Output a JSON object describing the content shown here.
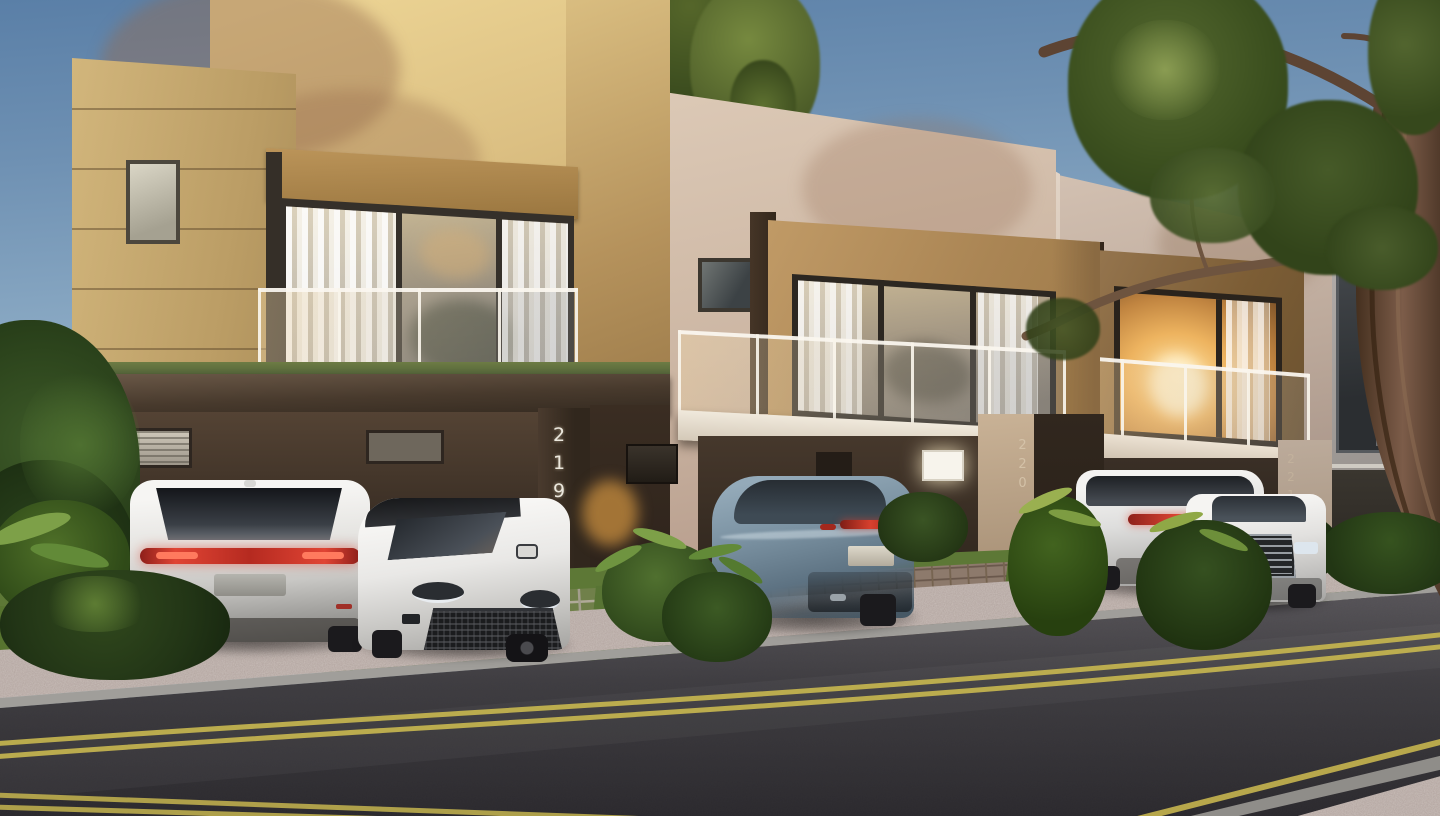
{
  "scene": {
    "house_numbers": {
      "house1": "219",
      "house2": "220",
      "house3": "221"
    },
    "palette": {
      "sky_top": "#5a7fa7",
      "sky_horizon": "#d6dcdc",
      "facade_yellow": "#dcc083",
      "facade_beige": "#cdb7a4",
      "facade_taupe": "#bca99b",
      "accent_tan": "#a9854e",
      "accent_brown": "#73552f",
      "carport_brown": "#3a2e24",
      "foliage_green": "#46592c",
      "lawn_green": "#587434",
      "gravel_pink": "#b1a39e",
      "asphalt_gray": "#39373b",
      "road_marking_yellow": "#c6b54f",
      "car_white": "#efeeec",
      "car_blue_gray": "#7b92a2",
      "taillight_red": "#d84434",
      "window_glow_warm": "#f0b964"
    }
  }
}
